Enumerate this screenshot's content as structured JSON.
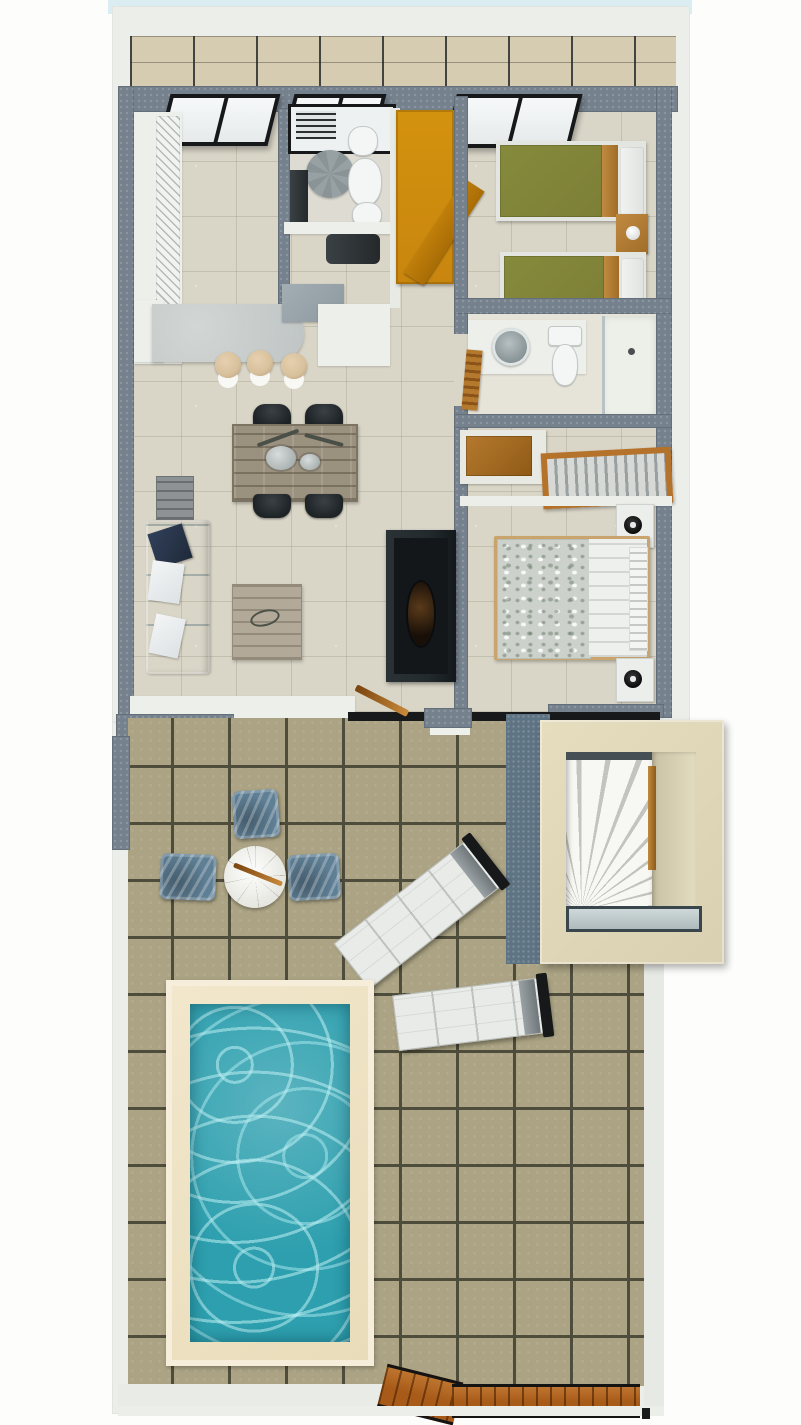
{
  "scene": {
    "type": "3d-floor-plan-render",
    "areas": [
      "balcony",
      "kitchen",
      "bathroom-1",
      "hallway",
      "twin-bedroom",
      "bathroom-2",
      "dressing-area",
      "master-bedroom",
      "living-dining-room",
      "terrace",
      "stairwell",
      "swimming-pool",
      "wood-deck"
    ],
    "furniture": [
      "kitchen-cabinets",
      "kitchen-island",
      "bar-stools",
      "shower-unit",
      "round-rug",
      "washbasin",
      "toilet",
      "bidet",
      "vanity-desk",
      "orange-wardrobe",
      "single-bed-1",
      "single-bed-2",
      "wood-nightstand",
      "vessel-sink",
      "walk-in-shower",
      "wooden-chair",
      "wardrobe",
      "luggage-rack",
      "double-bed",
      "white-nightstands",
      "table-lamps",
      "tv-cabinet",
      "sofa",
      "cushions",
      "dining-table",
      "dining-chairs",
      "coffee-table",
      "side-table",
      "outdoor-armchairs",
      "outdoor-round-table",
      "sun-lounger-1",
      "sun-lounger-2",
      "spiral-stairs",
      "glass-railing",
      "pool-water",
      "wood-walkway",
      "sliding-door"
    ]
  },
  "colors": {
    "frame_cyan": "#d9edf2",
    "wall_white": "#eceeea",
    "wall_gray": "#75828e",
    "interior_floor": "#d9d5c7",
    "balcony_tile": "#d5ccb2",
    "terrace_tile": "#aba383",
    "terrace_grout": "#4e4c3a",
    "window_frame": "#17181a",
    "window_pane": "#f7f9f9",
    "island_top": "#bfc5c4",
    "stool_top": "#d8c09c",
    "orange_wardrobe": "#c9860f",
    "bed_green": "#7c7f36",
    "wood": "#a06d28",
    "sofa_blue": "#a5d9e0",
    "pillow_navy": "#1f2a3a",
    "table_wood": "#9b917f",
    "chair_black": "#1e2326",
    "coffee_table": "#b2a999",
    "side_table": "#8d9394",
    "tv_unit": "#222a2e",
    "duvet_pattern": "#ccd2cb",
    "mattress_white": "#eef0ed",
    "nightstand_white": "#eceeec",
    "rug_gray": "#97a1a3",
    "porcelain": "#f4f6f5",
    "armchair_blue": "#5f7f95",
    "round_table_white": "#e7e7e1",
    "lounger_white": "#e9ebe8",
    "stair_frame": "#d9d0b1",
    "stair_wall": "#e4dcc0",
    "pool_deck": "#e9dcba",
    "pool_water": "#2d9fae",
    "deck_wood": "#a85a18"
  }
}
